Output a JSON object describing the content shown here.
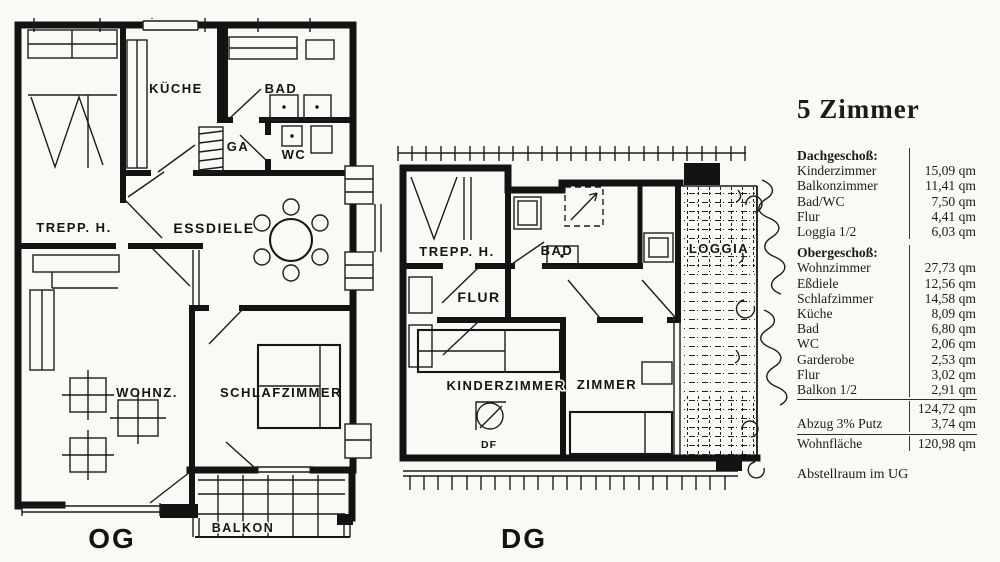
{
  "plans": {
    "og": {
      "floor": "OG",
      "trepp": "TREPP. H.",
      "kueche": "KÜCHE",
      "bad": "BAD",
      "ga": "GA",
      "wc": "WC",
      "essdiele": "ESSDIELE",
      "wohnz": "WOHNZ.",
      "schlafzimmer": "SCHLAFZIMMER",
      "balkon": "BALKON"
    },
    "dg": {
      "floor": "DG",
      "trepp": "TREPP. H.",
      "bad": "BAD",
      "loggia": "LOGGIA",
      "flur": "FLUR",
      "kinderzimmer": "KINDERZIMMER",
      "zimmer": "ZIMMER",
      "df": "DF"
    }
  },
  "panel": {
    "title": "5 Zimmer",
    "sections": [
      {
        "heading": "Dachgeschoß:",
        "rows": [
          {
            "label": "Kinderzimmer",
            "value": "15,09 qm"
          },
          {
            "label": "Balkonzimmer",
            "value": "11,41 qm"
          },
          {
            "label": "Bad/WC",
            "value": "7,50 qm"
          },
          {
            "label": "Flur",
            "value": "4,41 qm"
          },
          {
            "label": "Loggia 1/2",
            "value": "6,03 qm"
          }
        ]
      },
      {
        "heading": "Obergeschoß:",
        "rows": [
          {
            "label": "Wohnzimmer",
            "value": "27,73 qm"
          },
          {
            "label": "Eßdiele",
            "value": "12,56 qm"
          },
          {
            "label": "Schlafzimmer",
            "value": "14,58 qm"
          },
          {
            "label": "Küche",
            "value": "8,09 qm"
          },
          {
            "label": "Bad",
            "value": "6,80 qm"
          },
          {
            "label": "WC",
            "value": "2,06 qm"
          },
          {
            "label": "Garderobe",
            "value": "2,53 qm"
          },
          {
            "label": "Flur",
            "value": "3,02 qm"
          },
          {
            "label": "Balkon 1/2",
            "value": "2,91 qm"
          }
        ]
      }
    ],
    "subtotal": {
      "label": "",
      "value": "124,72 qm"
    },
    "deduction": {
      "label": "Abzug 3% Putz",
      "value": "3,74 qm"
    },
    "total": {
      "label": "Wohnfläche",
      "value": "120,98 qm"
    },
    "footnote": "Abstellraum im UG"
  }
}
